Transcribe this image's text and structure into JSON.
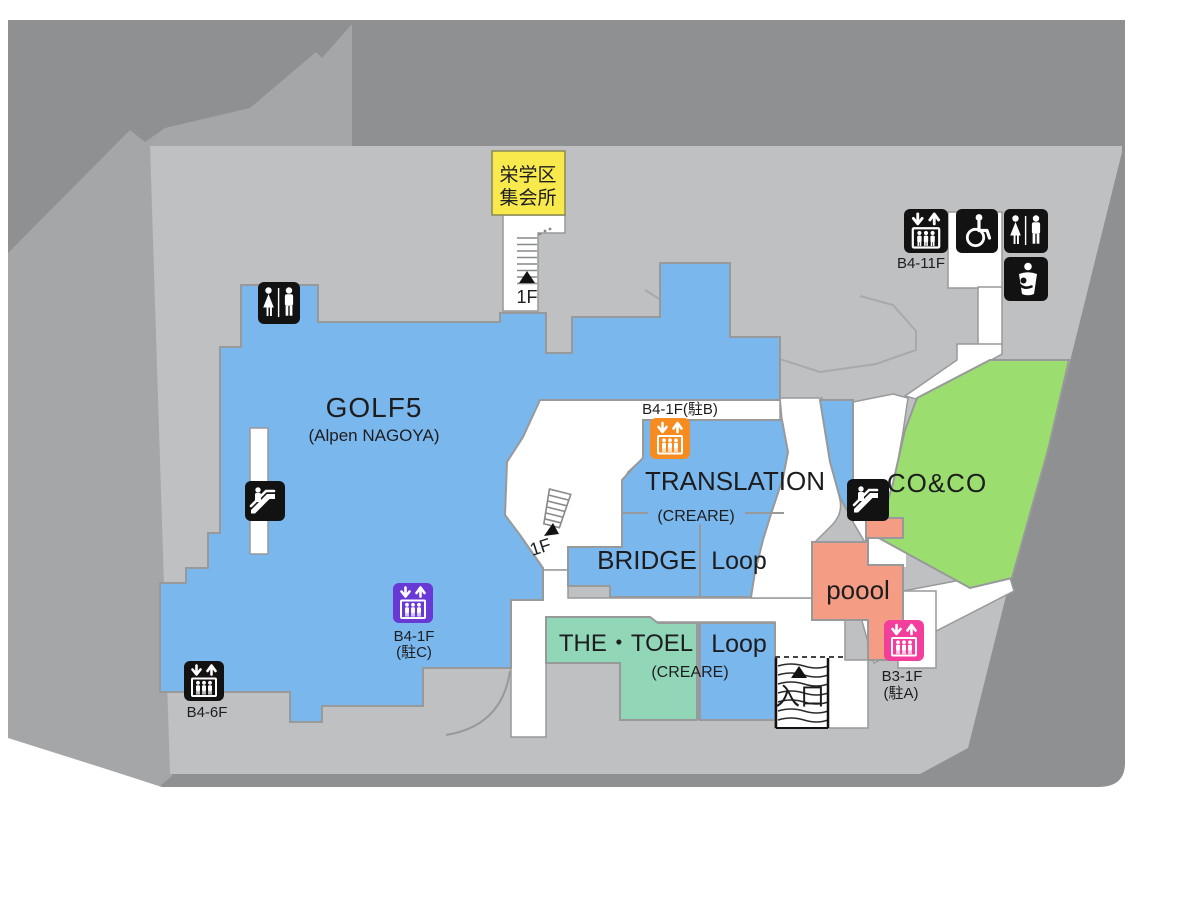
{
  "colors": {
    "outer_dark": "#8f9092",
    "outer_mid": "#a5a6a8",
    "floor": "#bfc0c2",
    "corridor_white": "#ffffff",
    "room_blue": "#7ab7ed",
    "room_green": "#9cdd6f",
    "room_teal": "#92d6b8",
    "room_salmon": "#f49d84",
    "room_yellow": "#f8e94d",
    "elevator_orange": "#f68b1f",
    "elevator_purple": "#6839d4",
    "elevator_pink": "#f33e9b",
    "icon_black": "#121212"
  },
  "rooms": {
    "golf5": {
      "name": "GOLF5",
      "subname": "(Alpen NAGOYA)"
    },
    "translation": {
      "name": "TRANSLATION",
      "subname": "(CREARE)"
    },
    "bridge": {
      "name": "BRIDGE"
    },
    "loop_upper": {
      "name": "Loop"
    },
    "the_toel": {
      "name": "THE・TOEL",
      "subname": "(CREARE)"
    },
    "loop_lower": {
      "name": "Loop"
    },
    "coco": {
      "name": "CO&CO"
    },
    "poool": {
      "name": "poool"
    },
    "meeting_hall": {
      "name_line1": "栄学区",
      "name_line2": "集会所"
    }
  },
  "labels": {
    "entrance": "入口",
    "stairs_upper_floor": "1F",
    "stairs_center_floor": "1F"
  },
  "facilities": {
    "elevator_b4_11f": {
      "label": "B4-11F"
    },
    "elevator_parking_b": {
      "label": "B4-1F(駐B)"
    },
    "elevator_parking_c": {
      "label_line1": "B4-1F",
      "label_line2": "(駐C)"
    },
    "elevator_b4_6f": {
      "label": "B4-6F"
    },
    "elevator_parking_a": {
      "label_line1": "B3-1F",
      "label_line2": "(駐A)"
    }
  }
}
